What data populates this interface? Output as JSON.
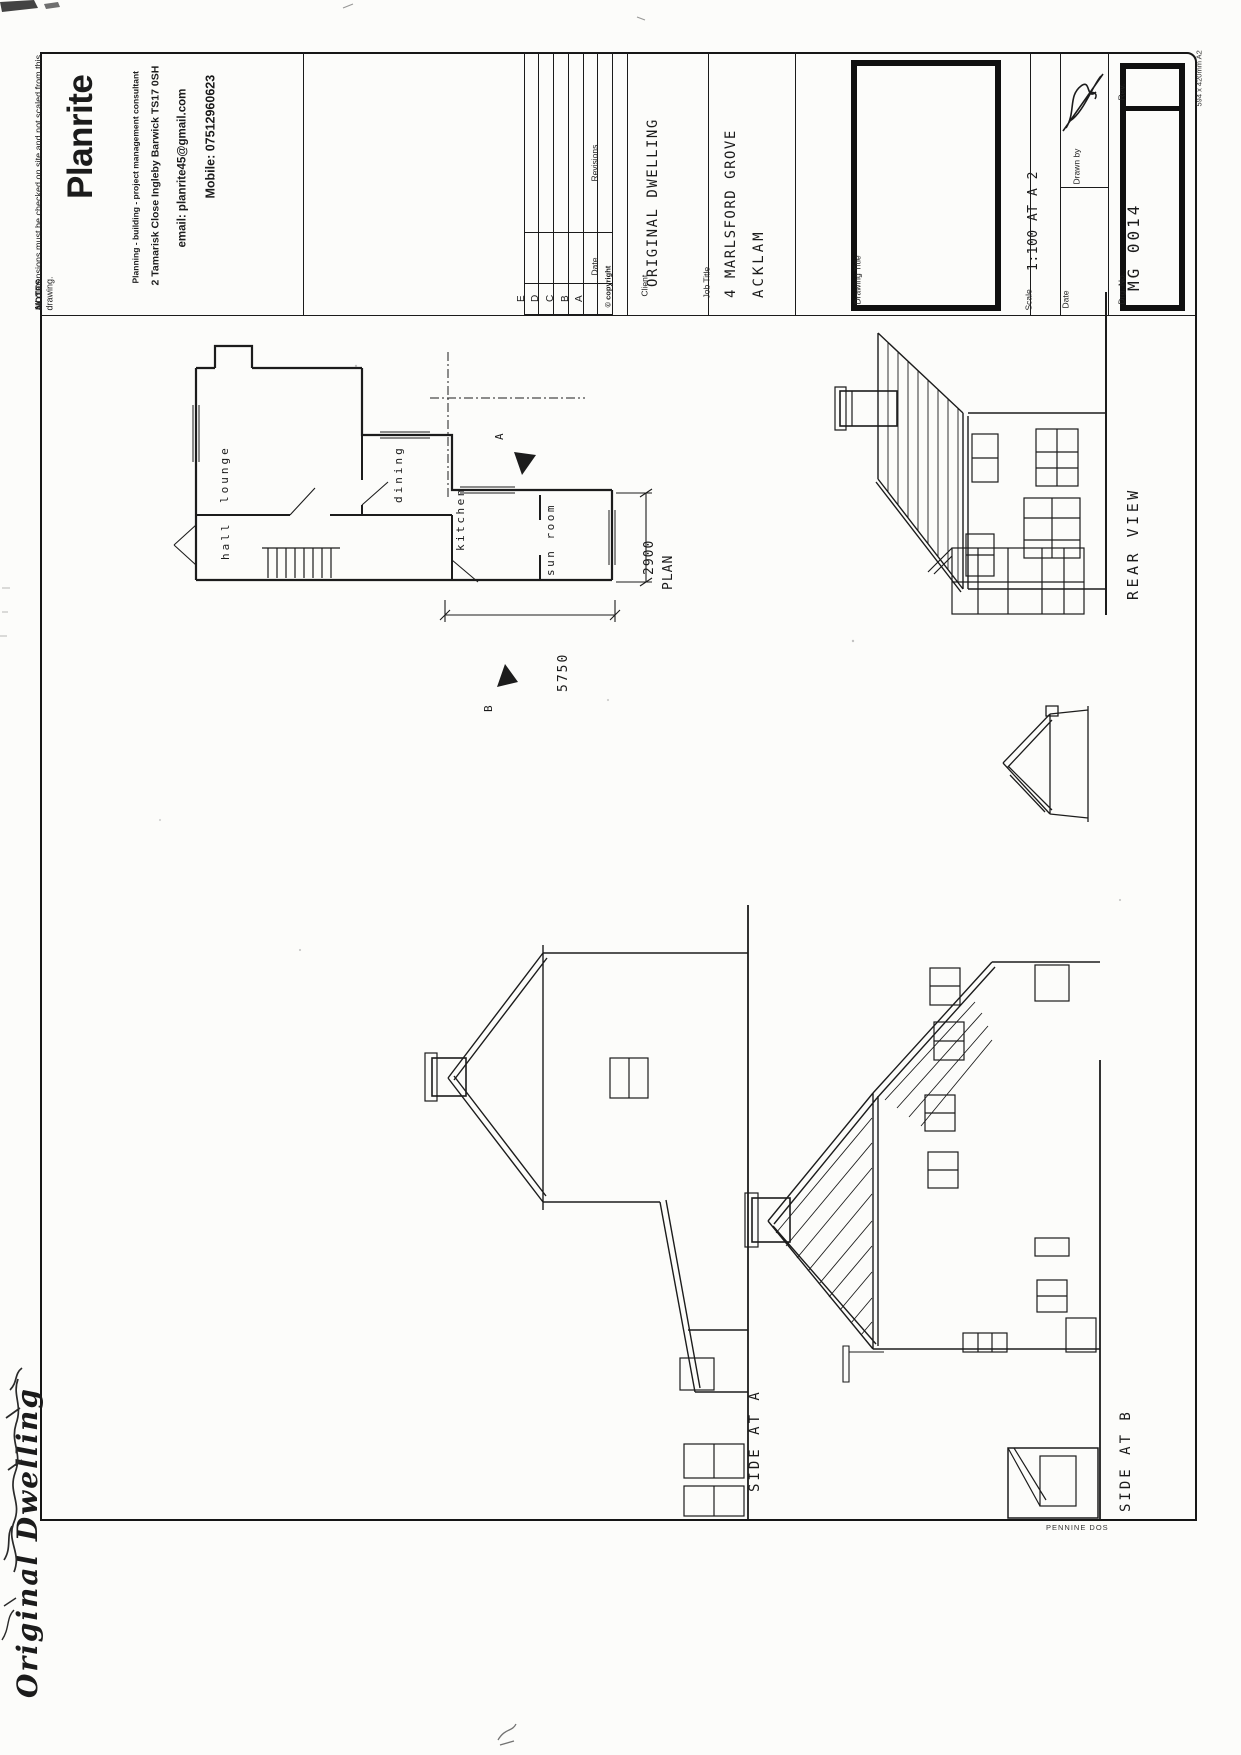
{
  "colors": {
    "paper": "#fcfcfa",
    "ink": "#1b1b1b"
  },
  "notes": {
    "title": "NOTES",
    "body": "All dimensions must be checked on site and not scaled from this drawing."
  },
  "brand": {
    "name": "Planrite",
    "tagline": "Planning - building - project management consultant",
    "address": "2 Tamarisk Close  Ingleby Barwick  TS17 0SH",
    "email": "email: planrite45@gmail.com",
    "mobile": "Mobile: 07512960623"
  },
  "revisions": {
    "header": "Revisions",
    "date_label": "Date",
    "row_letters": [
      "E",
      "D",
      "C",
      "B",
      "A"
    ],
    "copyright": "© copyright"
  },
  "title_block": {
    "client_label": "Client",
    "client": "ORIGINAL DWELLING",
    "job_title_label": "Job Title",
    "job_title_line1": "4 MARLSFORD GROVE",
    "job_title_line2": "ACKLAM",
    "drawing_title_label": "Drawing Title",
    "scale_label": "Scale",
    "scale_value": "1:100 AT A 2",
    "drawn_by_label": "Drawn by",
    "date_label": "Date",
    "drg_no_label": "Drg. No.",
    "drg_no": "MG 0014",
    "rev_label": "Rev.",
    "paper_size": "594 x 420mm A2"
  },
  "plan": {
    "rooms": [
      "lounge",
      "hall",
      "dining",
      "kitchen",
      "sun room"
    ],
    "dim_depth": "2900",
    "dim_depth_label": "PLAN",
    "dim_width": "5750",
    "section_marker_a": "A",
    "section_marker_b": "B"
  },
  "views": {
    "rear_label": "REAR VIEW",
    "side_a_label": "SIDE AT A",
    "side_b_label": "SIDE AT B"
  },
  "annotations": {
    "handwritten_title": "Original Dwelling",
    "stationer_mark": "PENNINE DOS"
  }
}
